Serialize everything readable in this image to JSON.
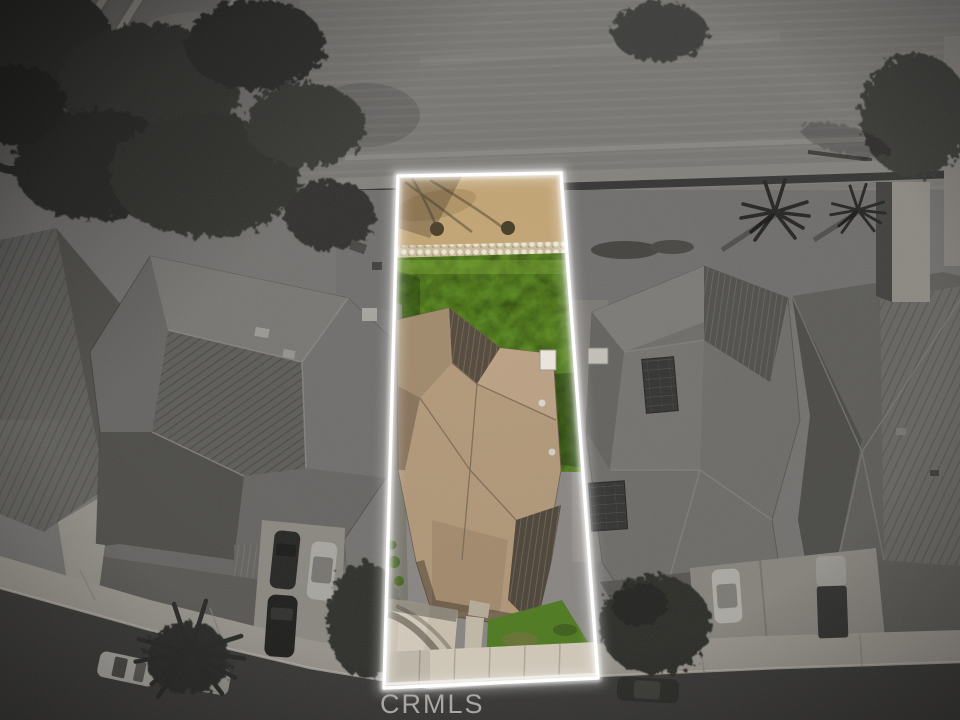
{
  "watermark": {
    "label": "CRMLS"
  },
  "photo": {
    "type": "aerial-listing-photo",
    "highlighted_lot_outline_points": "398,176 561,173 598,678 384,688"
  },
  "colors": {
    "outline": "#ffffff",
    "lawn": "#5c8a22",
    "lawn_front": "#507c20",
    "dirt": "#c4a675",
    "roof_tan": "#b3997a",
    "roof_tan_dark": "#53483a",
    "concrete": "#cdc3b2",
    "sidewalk": "#d6cdbd",
    "asphalt": "#454340",
    "field": "#8b8885",
    "watermark": "#b3b0ac"
  }
}
